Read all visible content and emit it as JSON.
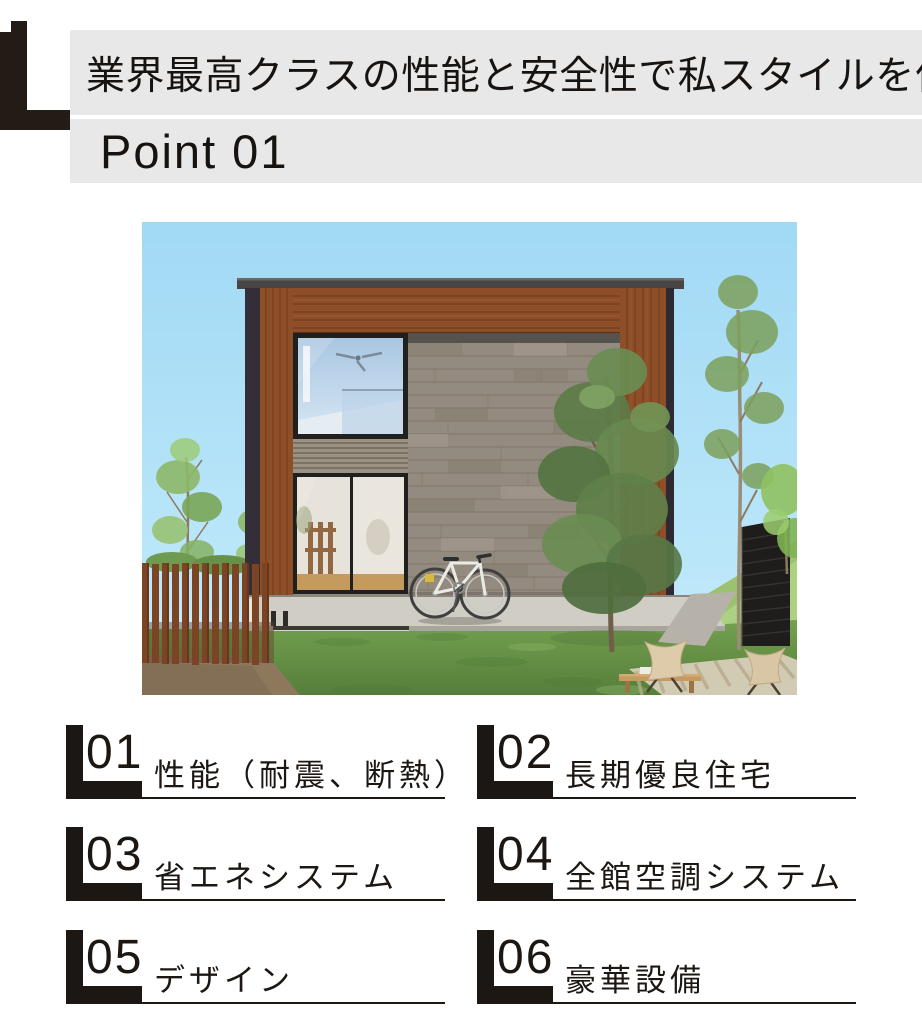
{
  "header": {
    "headline": "業界最高クラスの性能と安全性で私スタイルを作る",
    "point_label": "Point 01"
  },
  "hero_image": {
    "description": "モダンな箱型住宅の外観3Dパース（木目フレームの外壁、グレータイル壁、自転車、庭の樹木と椅子）"
  },
  "points": [
    {
      "number": "01",
      "label": "性能（耐震、断熱）"
    },
    {
      "number": "02",
      "label": "長期優良住宅"
    },
    {
      "number": "03",
      "label": "省エネシステム"
    },
    {
      "number": "04",
      "label": "全館空調システム"
    },
    {
      "number": "05",
      "label": "デザイン"
    },
    {
      "number": "06",
      "label": "豪華設備"
    }
  ],
  "colors": {
    "ink": "#1c1713",
    "banner_gray": "#e9e8e8",
    "sky_blue": "#a6dcf4",
    "wood_brown": "#8d4e28",
    "stone_gray": "#948b80",
    "grass_green": "#679549"
  }
}
